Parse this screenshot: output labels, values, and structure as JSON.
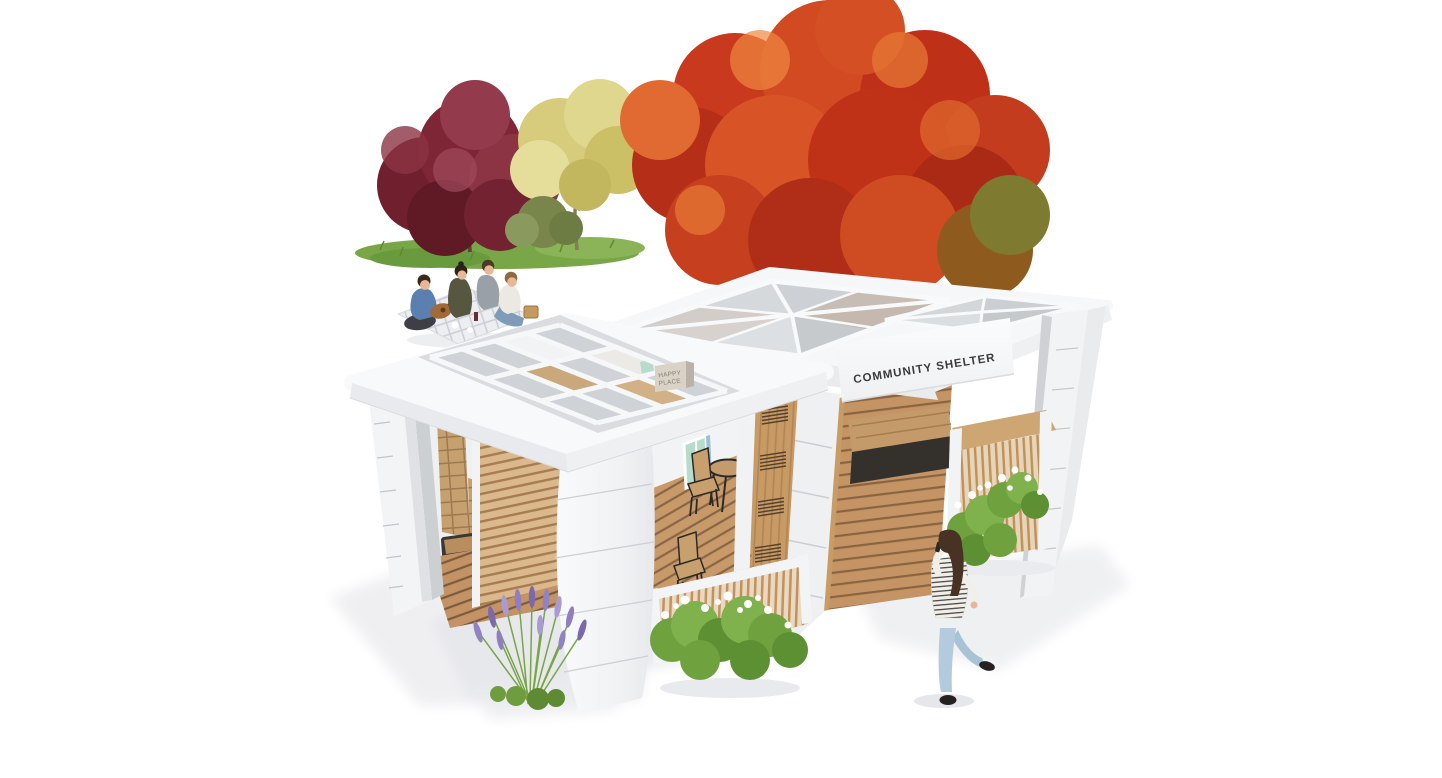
{
  "meta": {
    "kind": "architectural-3d-rendering",
    "view": "isometric exterior",
    "background": "#ffffff"
  },
  "signage": {
    "building_sign": "COMMUNITY SHELTER",
    "interior_sign": {
      "line1": "HAPPY",
      "line2": "PLACE"
    }
  },
  "palette": {
    "wall_white": "#f5f6f8",
    "wall_shade": "#e8eaec",
    "glass": "#cfd3d7",
    "glass_green": "#b7dccc",
    "wood_light": "#dcb98c",
    "wood_mid": "#c79a66",
    "deck": "#c39265",
    "bench_dark": "#3a3835",
    "maple_red": "#c8391d",
    "plum_burgundy": "#7e2636",
    "tree_yellow": "#d6cc7c",
    "grass_green": "#79a748",
    "shrub_green": "#74a843",
    "lavender_purple": "#8f7fc0",
    "denim_blue": "#a9c3d6",
    "sign_text": "#3b3b3d"
  },
  "scene": {
    "elements": [
      {
        "name": "red-maple-tree"
      },
      {
        "name": "burgundy-plum-tree"
      },
      {
        "name": "pale-yellow-tree"
      },
      {
        "name": "green-bush"
      },
      {
        "name": "grass-patch"
      },
      {
        "name": "picnic-group-with-guitar"
      },
      {
        "name": "walking-woman-on-phone"
      },
      {
        "name": "lavender-plants"
      },
      {
        "name": "white-flower-shrub-center"
      },
      {
        "name": "white-flower-shrub-right"
      },
      {
        "name": "left-pavilion-flat-grid-skylight"
      },
      {
        "name": "right-pavilion-pyramid-skylights"
      },
      {
        "name": "wood-louver-wall"
      },
      {
        "name": "wooden-deck-floor"
      },
      {
        "name": "cafe-chairs-and-round-table"
      },
      {
        "name": "dark-bench"
      },
      {
        "name": "wood-vent-door"
      },
      {
        "name": "wood-slat-counter"
      },
      {
        "name": "ground-shadows"
      }
    ]
  }
}
